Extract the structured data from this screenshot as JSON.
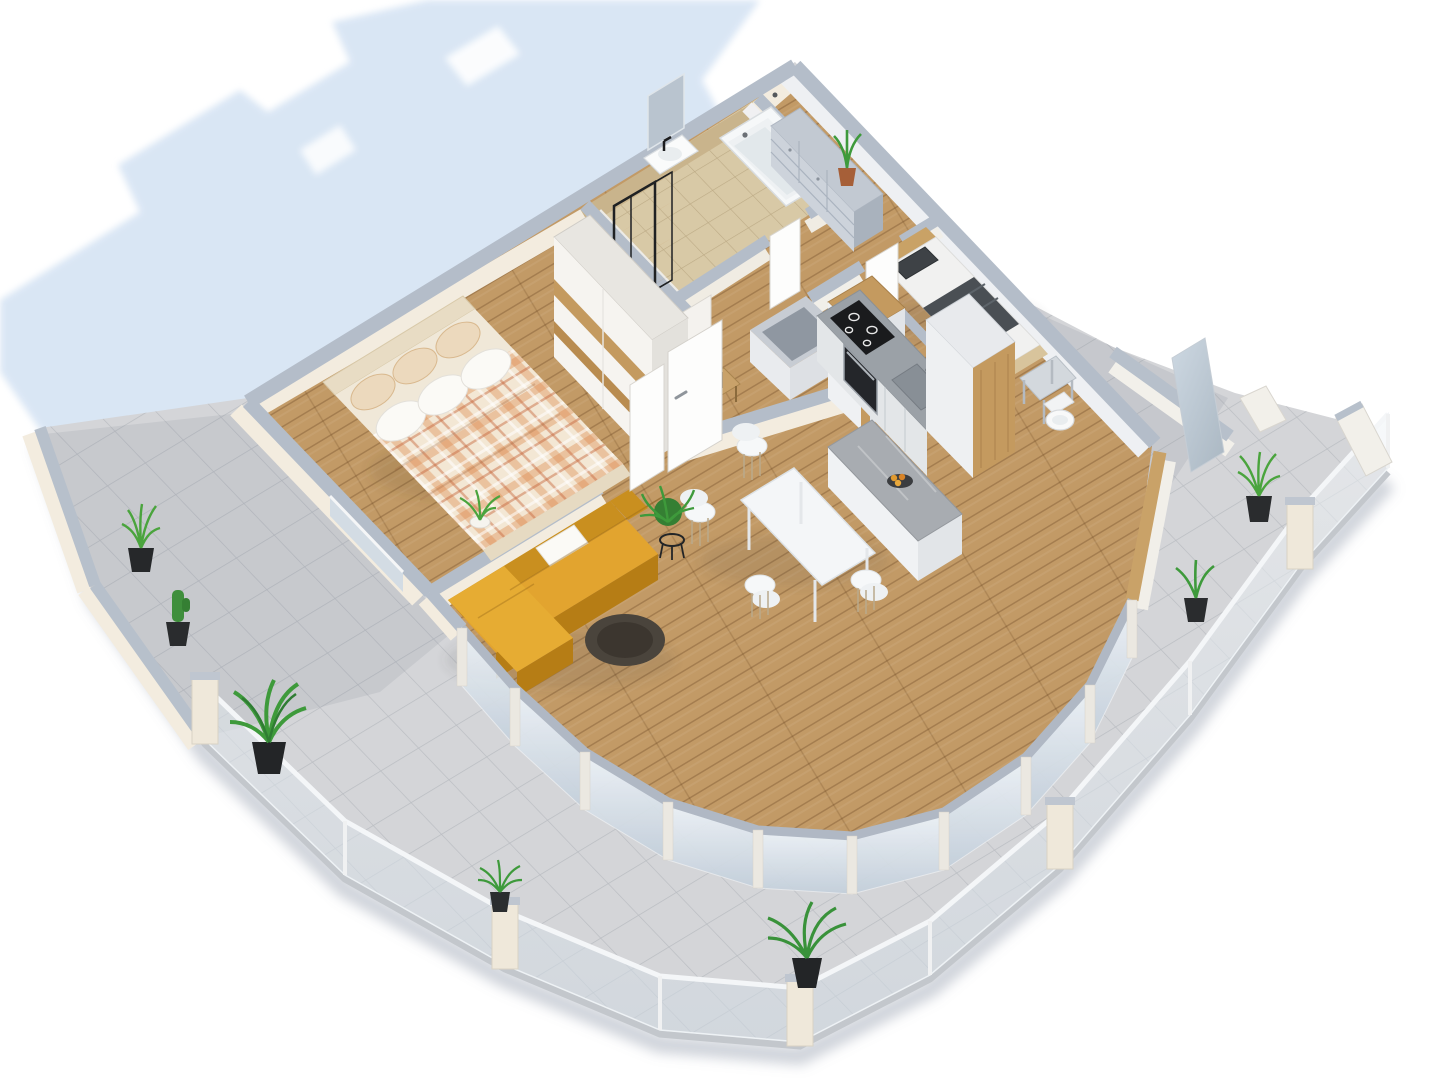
{
  "title": "3D isometric apartment floor plan render",
  "colors": {
    "background": "#ffffff",
    "shadow": "#d8e5f4",
    "balcony_tile": "#d4d5d8",
    "wood_floor": "#c29a66",
    "bath_floor": "#d8c9a6",
    "wall_top": "#b4bdc9",
    "wall_cream": "#f3ecdf",
    "wall_white": "#f0f0f2",
    "bath_wall_tile": "#c9b48c",
    "sofa": "#e2a42f",
    "sofa_shade": "#c98f1f",
    "sofa_skirt": "#b67d15",
    "rug": "#4a443c",
    "island_top": "#a8acb1",
    "counter_top": "#9ba1a7",
    "cooktop": "#1a1b1d",
    "cabinet_front": "#e3e6e8",
    "wood_panel": "#c49a5f",
    "knee_wall_wood": "#c9a268",
    "dresser": "#c2c9d2",
    "duvet_plaid_base": "#f3e7d4",
    "headboard": "#e8dcc4",
    "pillow_white": "#fbfaf6",
    "pillow_plaid": "#ecd9bd",
    "bed2_mattress": "#f1f1f0",
    "bed2_blanket": "#4a4f54",
    "bed2_frame": "#d8c49c",
    "bed2_headboard": "#c9a266",
    "table_top": "#f4f6f8",
    "chair": "#f6f8f9",
    "window_cap": "#b0b8c4",
    "glass_post": "#ebe8e1",
    "railing_post": "#efe8da",
    "plant": "#3e9a3b",
    "plant_dark": "#2f7d33",
    "pot_black": "#26282a",
    "pot_terracotta": "#a65f38",
    "tub_white": "#f6f8f9",
    "toilet_white": "#f8f9f9",
    "shelf_black": "#1f2123",
    "shelf_wood": "#c08a4f",
    "mirror": "#b9c4cf",
    "door_white": "#fdfdfc"
  },
  "scene": {
    "view": "isometric cutaway dollhouse top view of an apartment",
    "rooms": [
      "bedroom",
      "bathroom",
      "entry-hall",
      "hallway",
      "second-bedroom",
      "kitchen",
      "living-dining",
      "wrap-around-balcony"
    ],
    "furniture": [
      "double-bed-with-plaid-duvet",
      "sliding-wardrobe",
      "bathtub",
      "wall-sink",
      "mirror",
      "black-shelf-unit",
      "entry-dresser",
      "single-bed",
      "side-desk",
      "toilet",
      "kitchen-counter-with-cooktop-oven-sink",
      "tall-cabinets",
      "kitchen-island-with-fruit-bowl",
      "dining-table",
      "yellow-corner-sofa",
      "white-cushion",
      "round-rug",
      "plant-stand"
    ],
    "balcony_plants": 7,
    "dining_chairs": 4
  }
}
